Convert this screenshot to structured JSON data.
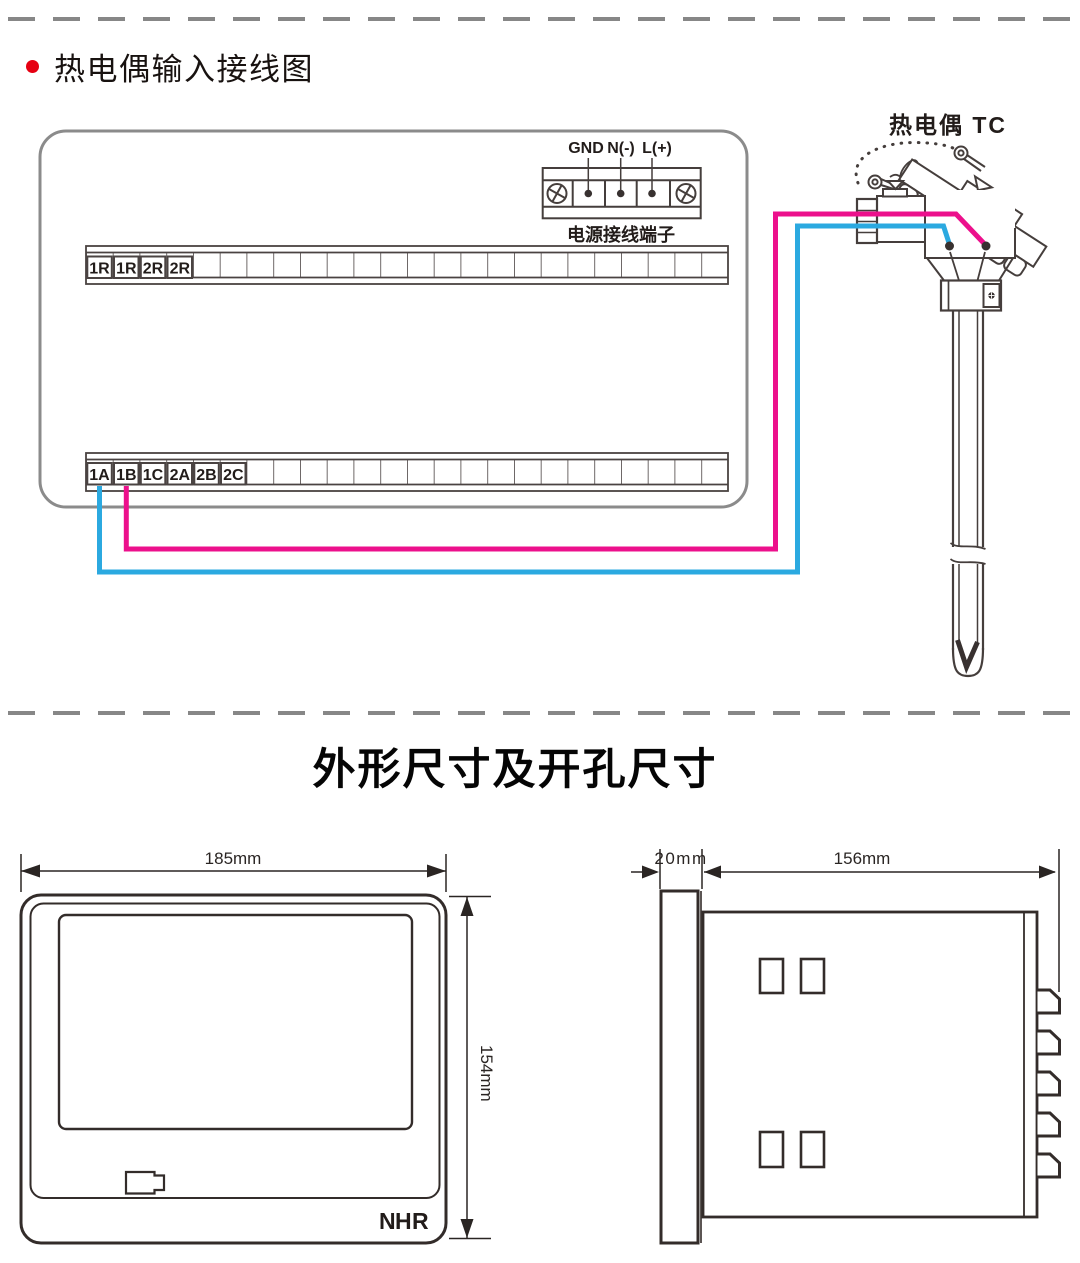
{
  "section_wiring": {
    "title": "热电偶输入接线图",
    "power_terminal": {
      "caption": "电源接线端子",
      "labels": [
        "GND",
        "N(-)",
        "L(+)"
      ]
    },
    "upper_strip_labels": [
      "1R",
      "1R",
      "2R",
      "2R"
    ],
    "lower_strip_labels": [
      "1A",
      "1B",
      "1C",
      "2A",
      "2B",
      "2C"
    ],
    "sensor_label": "热电偶 TC",
    "colors": {
      "wire_positive": "#ec108c",
      "wire_negative": "#2ba9e0",
      "bullet_red": "#e60012"
    }
  },
  "section_dimensions": {
    "title": "外形尺寸及开孔尺寸",
    "front_view": {
      "width_label": "185mm",
      "height_label": "154mm",
      "logo": {
        "n": "N",
        "h": "H",
        "r": "R"
      },
      "logo_colors": {
        "gray": "#b4bac1",
        "red": "#cd3a26"
      }
    },
    "side_view": {
      "panel_depth_label": "20mm",
      "body_depth_label": "156mm"
    }
  }
}
